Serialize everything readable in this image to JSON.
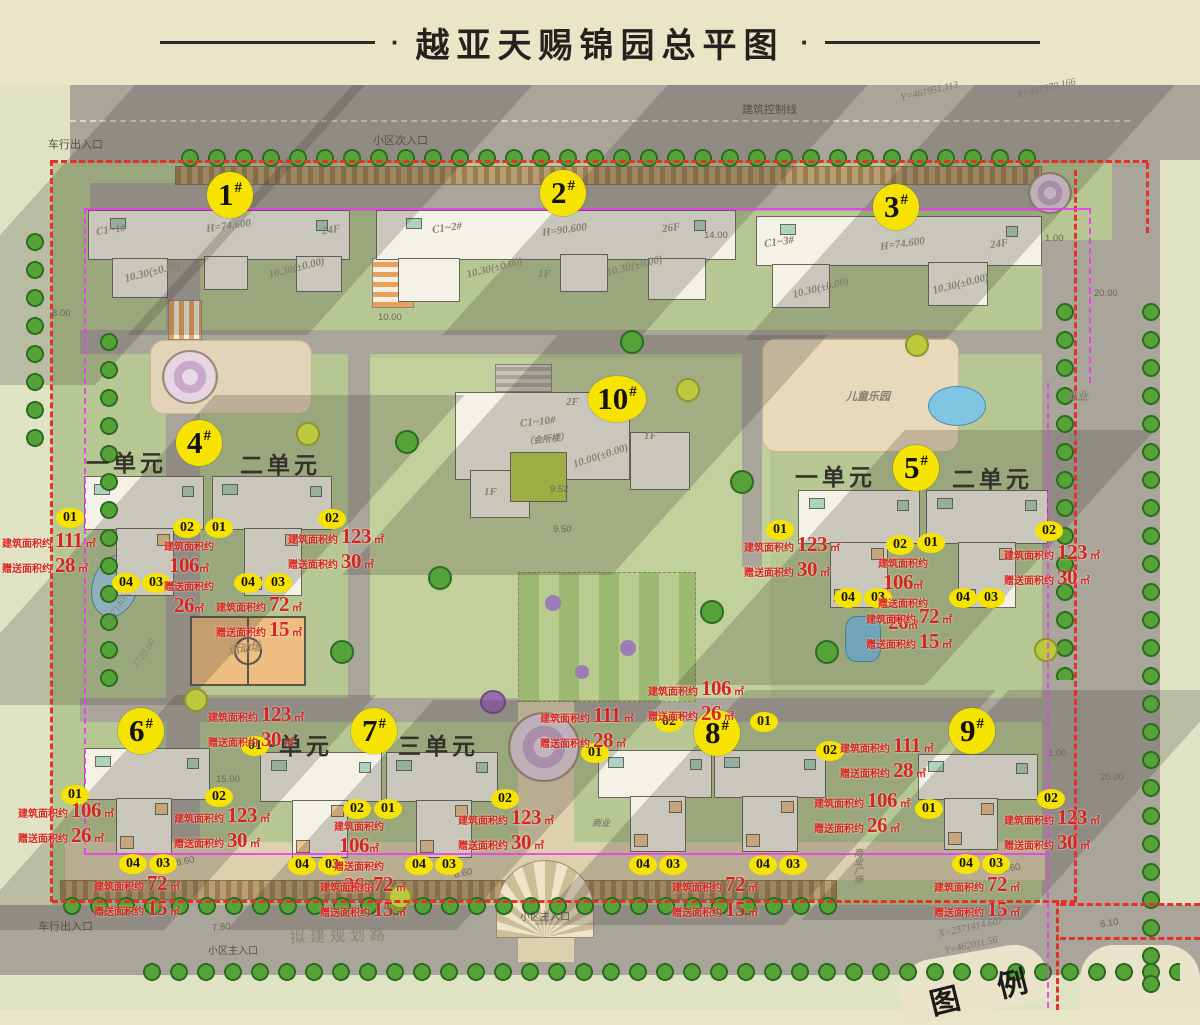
{
  "title": "越亚天赐锦园总平图",
  "buildings": [
    {
      "num": "1",
      "suffix": "#"
    },
    {
      "num": "2",
      "suffix": "#"
    },
    {
      "num": "3",
      "suffix": "#"
    },
    {
      "num": "4",
      "suffix": "#"
    },
    {
      "num": "5",
      "suffix": "#"
    },
    {
      "num": "6",
      "suffix": "#"
    },
    {
      "num": "7",
      "suffix": "#"
    },
    {
      "num": "8",
      "suffix": "#"
    },
    {
      "num": "9",
      "suffix": "#"
    },
    {
      "num": "10",
      "suffix": "#"
    }
  ],
  "unit_labels": {
    "b4_left": "一单元",
    "b4_right": "二单元",
    "b5_left": "一单元",
    "b5_right": "二单元",
    "b7_left": "一单元",
    "b7_right": "三单元"
  },
  "area_labels": {
    "build": "建筑面积约",
    "gift": "赠送面积约",
    "sqm": "㎡"
  },
  "annotations": [
    {
      "units": [
        "01"
      ],
      "build": "111",
      "gift": "28"
    },
    {
      "units": [
        "02",
        "01"
      ],
      "build": "106",
      "gift": "26"
    },
    {
      "units": [
        "04",
        "03"
      ]
    },
    {
      "units": [
        "04",
        "03"
      ],
      "build": "72",
      "gift": "15"
    },
    {
      "units": [
        "02"
      ],
      "build": "123",
      "gift": "30"
    },
    {
      "units": [
        "01"
      ],
      "build": "123",
      "gift": "30"
    },
    {
      "units": [
        "02",
        "01"
      ],
      "build": "106",
      "gift": "26"
    },
    {
      "units": [
        "04",
        "03"
      ],
      "build": "72",
      "gift": "15"
    },
    {
      "units": [
        "04",
        "03"
      ]
    },
    {
      "units": [
        "02"
      ],
      "build": "123",
      "gift": "30"
    },
    {
      "units": [
        "01"
      ],
      "build": "106",
      "gift": "26"
    },
    {
      "units": [
        "02"
      ],
      "build": "123",
      "gift": "30"
    },
    {
      "units": [
        "04",
        "03"
      ],
      "build": "72",
      "gift": "15"
    },
    {
      "units": [
        "01"
      ],
      "build": "123",
      "gift": "30"
    },
    {
      "units": [
        "02",
        "01"
      ],
      "build": "106",
      "gift": "26"
    },
    {
      "units": [
        "04",
        "03"
      ]
    },
    {
      "units": [
        "04",
        "03"
      ],
      "build": "72",
      "gift": "15"
    },
    {
      "units": [
        "02"
      ],
      "build": "123",
      "gift": "30"
    },
    {
      "units": [
        "01"
      ],
      "build": "111",
      "gift": "28"
    },
    {
      "units": [
        "02",
        "01"
      ],
      "build": "106",
      "gift": "26"
    },
    {
      "units": [
        "02"
      ],
      "build": "111",
      "gift": "28"
    },
    {
      "units": [
        "01"
      ],
      "build": "106",
      "gift": "26"
    },
    {
      "units": [
        "04",
        "03"
      ]
    },
    {
      "units": [
        "04",
        "03"
      ],
      "build": "72",
      "gift": "15"
    },
    {
      "units": [
        "02"
      ],
      "build": "123",
      "gift": "30"
    },
    {
      "units": [
        "04",
        "03"
      ],
      "build": "72",
      "gift": "15"
    }
  ],
  "map_texts": {
    "entry_north": "小区次入口",
    "vehicle_gate_top": "车行出入口",
    "control_line": "建筑控制线",
    "vehicle_gate_bottom": "车行出入口",
    "main_entry_small": "小区主入口",
    "main_entry": "小区主入口",
    "planned_road": "拟建规划路",
    "legend": "图 例",
    "sport": "运动场",
    "playground": "儿童乐园",
    "biz": "商业",
    "biz_floor": "1F",
    "plaza": "商业广场"
  },
  "bldg_texts": {
    "c1_1": "C1~1#",
    "h1": "H=74.600",
    "f1": "24F",
    "lvl": "10.30(±0.00)",
    "c1_2": "C1~2#",
    "h2": "H=90.600",
    "f2": "26F",
    "fl1": "1F",
    "d14": "14.00",
    "c1_3": "C1~3#",
    "h3": "H=74.600",
    "f3": "24F",
    "c1_10": "C1~10#",
    "club": "（会所楼）",
    "f2f": "2F",
    "lvl10": "10.00(±0.00)",
    "e952": "9.52",
    "e950": "9.50"
  },
  "dims": {
    "d800": "8.00",
    "d1000": "10.00",
    "d2000": "20.00",
    "d100": "1.00",
    "d1500": "15.00",
    "d860": "8.60",
    "d780": "7.80",
    "d810": "8.10"
  },
  "coords": {
    "c1": "Y=461951.113",
    "c2": "X=461970.166",
    "c3": "X=2371414.607",
    "c4": "Y=462011.56",
    "c5": "2371406.0",
    "c6": "1725.60"
  }
}
